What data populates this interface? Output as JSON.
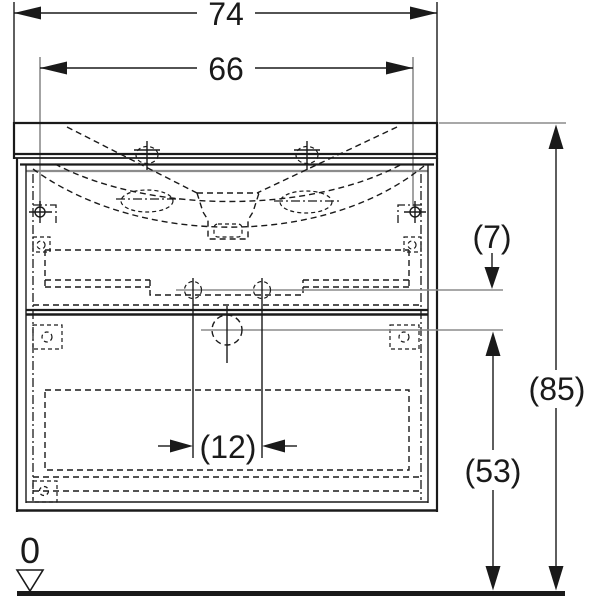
{
  "drawing": {
    "dimensions": {
      "basin_width": {
        "label": "74",
        "value": 74
      },
      "fixing_width": {
        "label": "66",
        "value": 66
      },
      "offset_supply_to_drain": {
        "label": "(7)",
        "value": 7
      },
      "basin_height_above_floor": {
        "label": "(85)",
        "value": 85
      },
      "drain_height_above_floor": {
        "label": "(53)",
        "value": 53
      },
      "center_clearance_width": {
        "label": "(12)",
        "value": 12
      },
      "floor_datum": {
        "label": "0",
        "value": 0
      }
    },
    "colors": {
      "line": "#1a1a1a",
      "reference_line": "#8c8c8c",
      "background": "#ffffff"
    }
  }
}
